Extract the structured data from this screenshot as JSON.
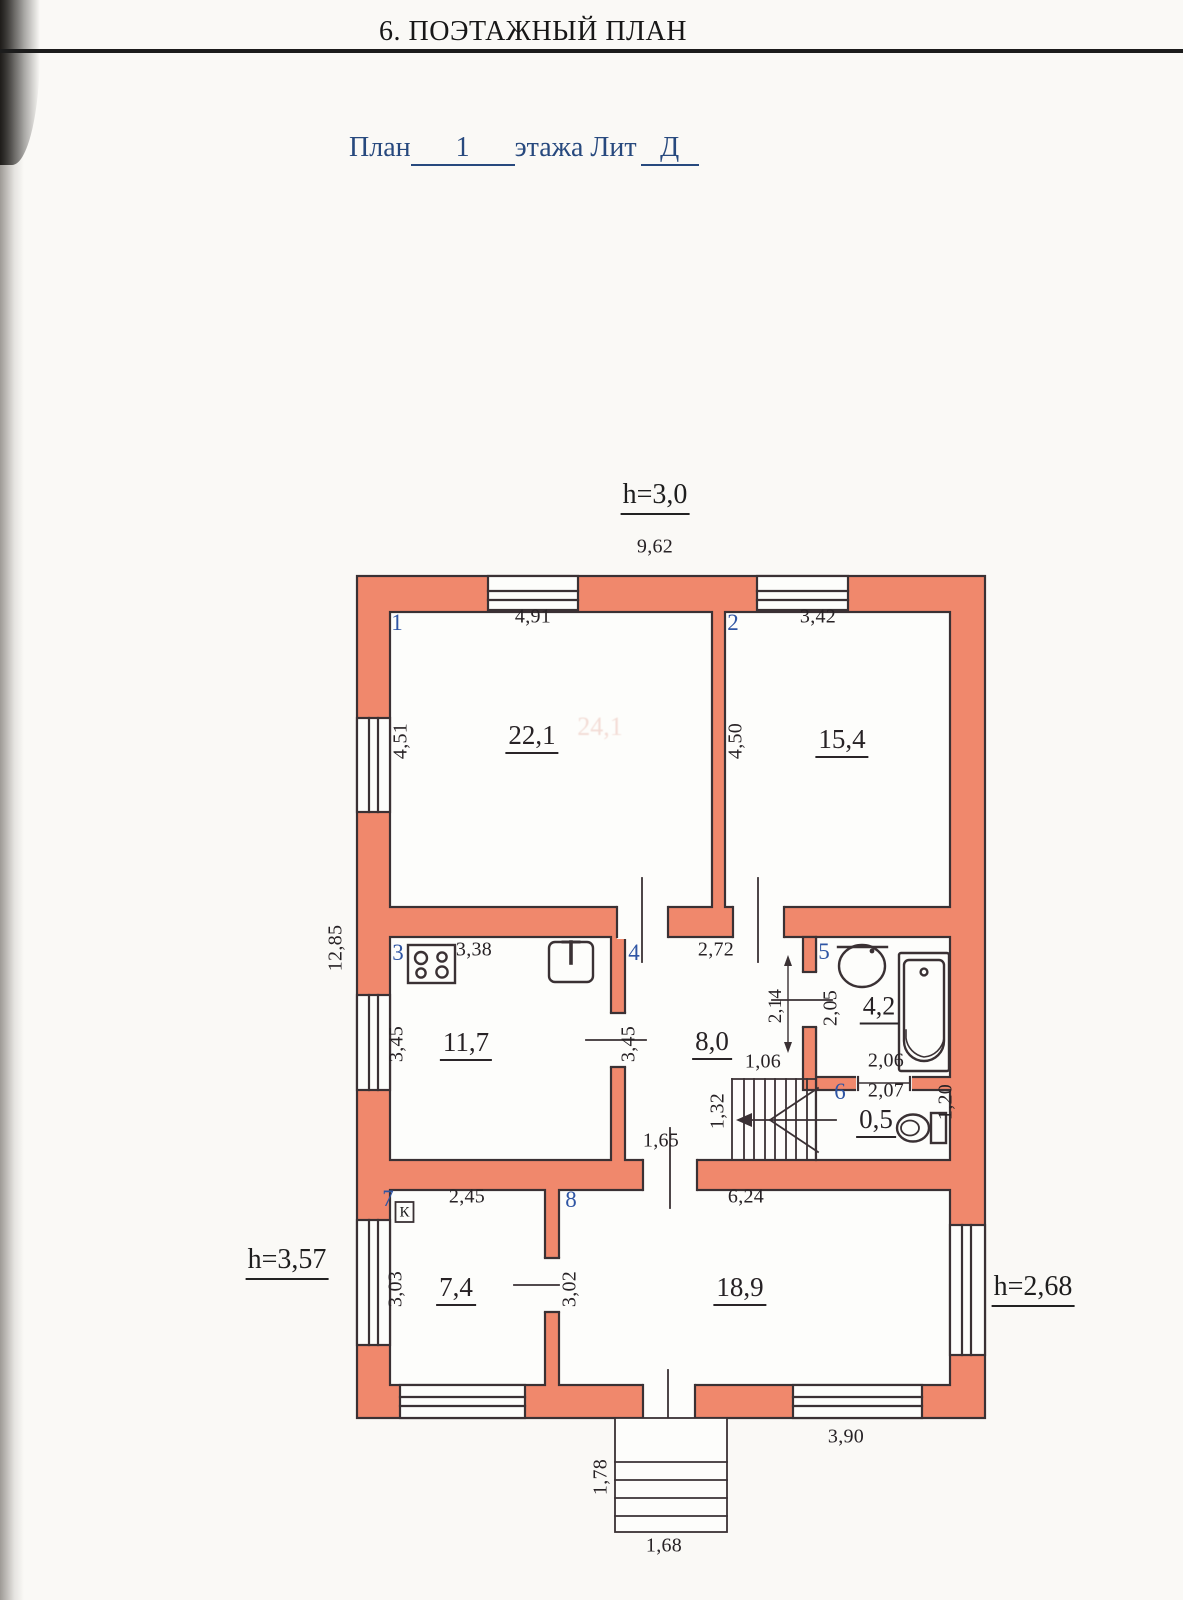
{
  "scan": {
    "header_title": "6. ПОЭТАЖНЫЙ ПЛАН"
  },
  "caption": {
    "word_plan": "План",
    "floor_number": "1",
    "word_floor": "этажа Лит",
    "liter": "Д"
  },
  "heights": {
    "top": "h=3,0",
    "left": "h=3,57",
    "right": "h=2,68"
  },
  "outer_dims": {
    "top_width": "9,62",
    "left_height": "12,85",
    "bottom_right": "3,90"
  },
  "porch": {
    "depth": "1,78",
    "width": "1,68"
  },
  "stairs": {
    "width": "1,06",
    "run": "1,32",
    "hall_door": "1,65"
  },
  "bleed_through": "24,1",
  "rooms": [
    {
      "num": "1",
      "area": "22,1",
      "width": "4,91",
      "height": "4,51"
    },
    {
      "num": "2",
      "area": "15,4",
      "width": "3,42",
      "height": "4,50"
    },
    {
      "num": "3",
      "area": "11,7",
      "width": "3,38",
      "height": "3,45"
    },
    {
      "num": "4",
      "area": "8,0",
      "width": "2,72",
      "height": "3,45",
      "niche": "2,14"
    },
    {
      "num": "5",
      "area": "4,2",
      "width": "2,06",
      "height": "2,05"
    },
    {
      "num": "6",
      "area": "0,5",
      "width": "2,07",
      "height": "1,20"
    },
    {
      "num": "7",
      "area": "7,4",
      "width": "2,45",
      "height": "3,03",
      "symbol": "К"
    },
    {
      "num": "8",
      "area": "18,9",
      "width": "6,24",
      "height": "3,02"
    }
  ],
  "colors": {
    "wall_fill": "#f0886c",
    "outline": "#3a3134",
    "room_number_blue": "#2f55a4",
    "caption_blue": "#27497e"
  }
}
